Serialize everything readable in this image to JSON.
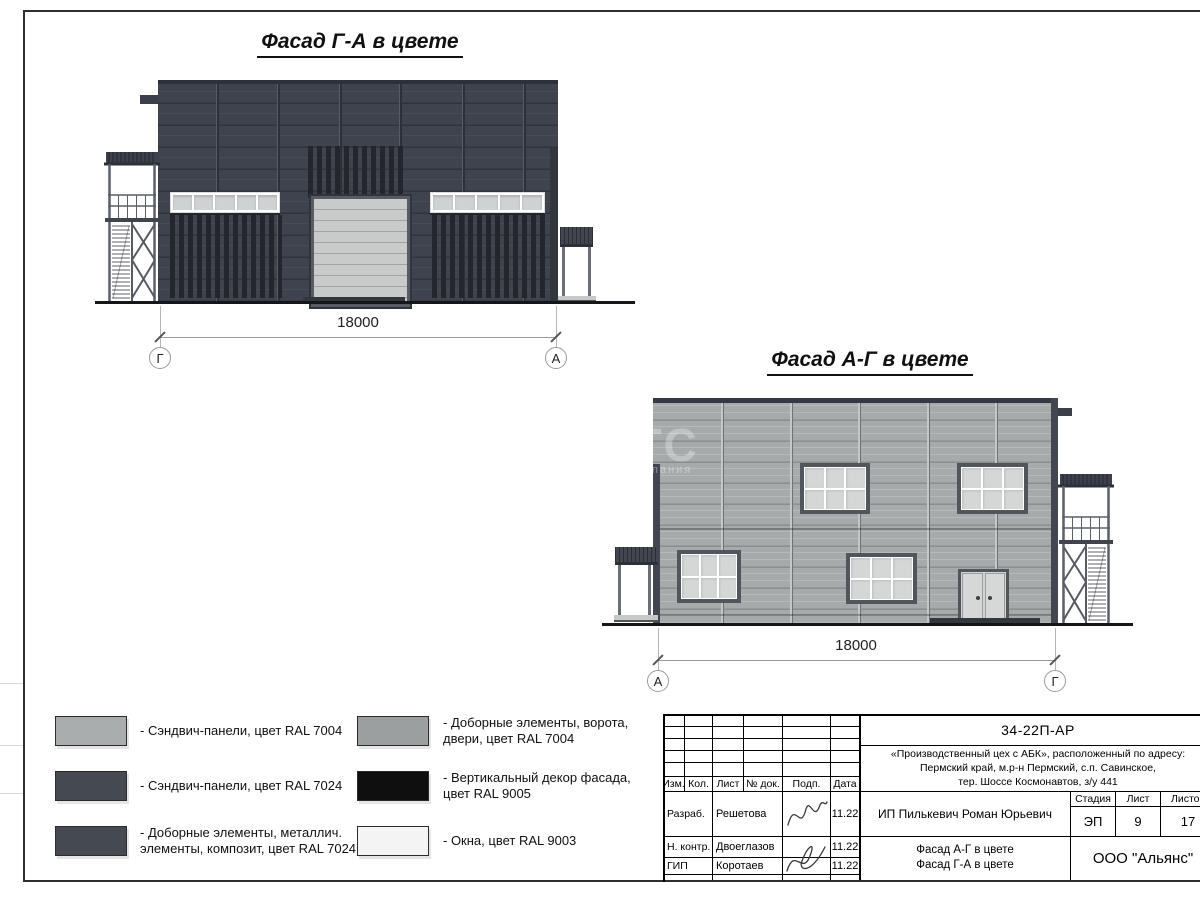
{
  "palette": {
    "frame": "#2f2f2f",
    "dark_panel": "#3e434e",
    "dark_panel_line": "#474c57",
    "dark_joint": "#2c303a",
    "black_decor": "#23262d",
    "light_panel": "#a6aaaa",
    "light_joint_dark": "#6f7373",
    "window_light": "#d2d4d4",
    "gate_gray": "#c9cbcb",
    "metal_dark": "#42474f",
    "steel": "#565b64",
    "ink": "#000000"
  },
  "facade_ga": {
    "title": "Фасад Г-А в цвете",
    "dimension": "18000",
    "axis_left": "Г",
    "axis_right": "А"
  },
  "facade_ag": {
    "title": "Фасад А-Г в цвете",
    "dimension": "18000",
    "axis_left": "А",
    "axis_right": "Г"
  },
  "watermark": {
    "large": "ГС",
    "small": "пания"
  },
  "legend": {
    "items": [
      {
        "label": "- Сэндвич-панели, цвет RAL 7004",
        "color": "#a9adad"
      },
      {
        "label": "- Сэндвич-панели, цвет RAL 7024",
        "color": "#454a52"
      },
      {
        "label": "- Доборные элементы, металлич. элементы, композит, цвет RAL 7024",
        "color": "#454a52"
      },
      {
        "label": "- Доборные элементы, ворота, двери, цвет RAL 7004",
        "color": "#9b9f9f"
      },
      {
        "label": "- Вертикальный декор фасада, цвет RAL 9005",
        "color": "#0f0f0f"
      },
      {
        "label": "- Окна, цвет RAL 9003",
        "color": "#f4f4f4"
      }
    ]
  },
  "stamp": {
    "doc_code": "34-22П-АР",
    "project": [
      "«Производственный цех с АБК», расположенный по адресу:",
      "Пермский край, м.р-н Пермский, с.п. Савинское,",
      "тер. Шоссе Космонавтов, з/у 441"
    ],
    "columns": {
      "izm": "Изм.",
      "kol": "Кол.",
      "list": "Лист",
      "doc_no": "№ док.",
      "sign": "Подп.",
      "date": "Дата"
    },
    "stage_header": "Стадия",
    "sheet_header": "Лист",
    "sheets_header": "Листов",
    "stage": "ЭП",
    "sheet": "9",
    "sheets": "17",
    "client": "ИП Пилькевич Роман Юрьевич",
    "rows": [
      {
        "role": "Разраб.",
        "name": "Решетова",
        "date": "11.22"
      },
      {
        "role": "Н. контр.",
        "name": "Двоеглазов",
        "date": "11.22"
      },
      {
        "role": "ГИП",
        "name": "Коротаев",
        "date": "11.22"
      }
    ],
    "sheet_title": [
      "Фасад А-Г в цвете",
      "Фасад Г-А в цвете"
    ],
    "organization": "ООО \"Альянс\""
  }
}
